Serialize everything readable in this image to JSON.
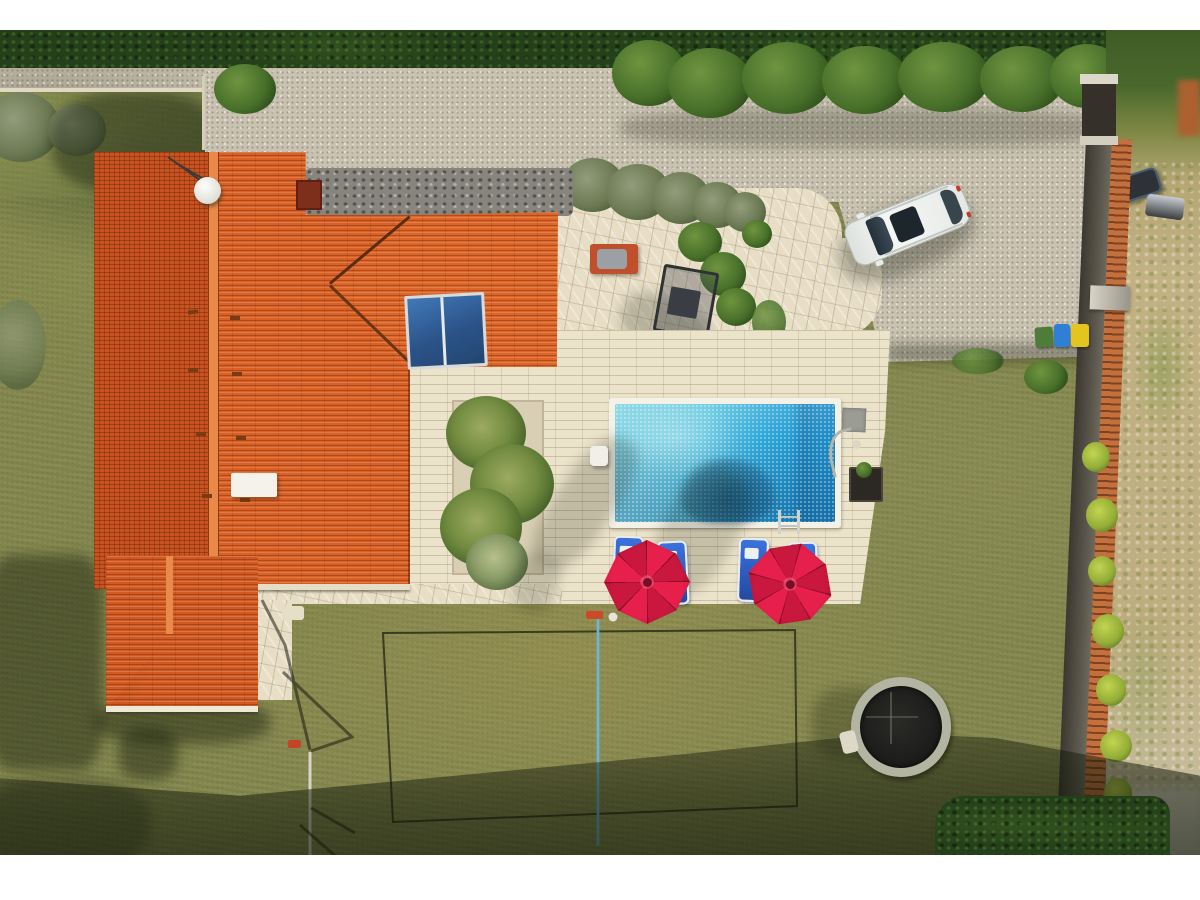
{
  "scene": {
    "description": "Top-down aerial drone photo of a holiday villa: large orange tiled roof, gravel driveway with a parked white SUV, flagstone patio, rectangular blue swimming pool with four blue sun loungers and two red parasols, khaki lawn with a badminton court and sunken trampoline, enclosed by dark hedges and a tile-capped boundary wall, with white letterbox bars top and bottom",
    "letterbox_color": "#ffffff",
    "counts": {
      "parasols": 2,
      "sun_loungers": 4,
      "waste_bins": 3,
      "cars": 1,
      "trampolines": 1
    },
    "objects": {
      "house": "villa with orange tiled hip roof",
      "roof_panel": "rooftop solar panel pair",
      "satellite_dish": "white satellite dish with TV antenna",
      "chimney": "brick chimney",
      "vent_box": "white rooftop vent box",
      "driveway": "light gravel driveway",
      "car": "white SUV parked on gravel",
      "patio": "flagstone patio with olive shrubs",
      "bbq": "orange barbecue table with grey cover",
      "swing": "dark garden swing seat",
      "deck": "paved pool terrace",
      "grass_bed": "bed of ornamental grass tufts",
      "pool": "rectangular swimming pool",
      "pool_ladder": "chrome pool ladder",
      "solar_mat": "black pool solar heater mat with hose",
      "lounger": "blue sun lounger",
      "parasol": "red pool parasol",
      "court": "badminton court line markings on lawn",
      "net": "badminton net seen from above",
      "trampoline": "sunken trampoline with grey rim",
      "wall": "boundary wall with orange tile coping",
      "gate": "dark entrance gate between white pillars",
      "bins": [
        "green waste bin",
        "blue waste bin",
        "yellow waste bin"
      ],
      "hedge": "dark green boundary hedge",
      "road": "gravel lane outside the plot",
      "neighbor": "dry neighbouring plot with parked motorbike and trailer"
    },
    "palette": {
      "roof_orange": "#d96125",
      "roof_orange_dark": "#c85320",
      "pool_light": "#84d4e4",
      "pool_deep": "#1d89c4",
      "parasol_red": "#e6204b",
      "lounger_blue": "#3b72dd",
      "grass_olive": "#85894f",
      "gravel_grey": "#c9c2b1",
      "paver_beige": "#ece3cb",
      "hedge_green": "#24401a",
      "bin_green": "#4e7d3a",
      "bin_blue": "#2f7fd6",
      "bin_yellow": "#e4c41f",
      "car_white": "#eff1ee"
    }
  }
}
